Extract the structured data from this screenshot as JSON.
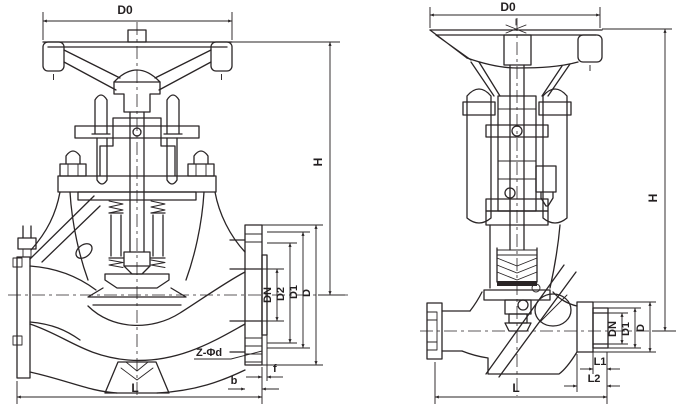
{
  "page": {
    "background": "#ffffff",
    "line_color": "#2a2526"
  },
  "figure": {
    "type": "technical-drawing",
    "description": "Dimensional cross-section drawings of two globe valves: flanged pattern (left) and welded-end pattern (right)",
    "left_valve": {
      "labels": {
        "d0": "D0",
        "h": "H",
        "dn": "DN",
        "d2": "D2",
        "d1": "D1",
        "d": "D",
        "z_phi_d": "Z-Φd",
        "b": "b",
        "f": "f",
        "l": "L"
      }
    },
    "right_valve": {
      "labels": {
        "d0": "D0",
        "h": "H",
        "dn": "DN",
        "d1": "D1",
        "d": "D",
        "l1": "L1",
        "l2": "L2",
        "l": "L"
      }
    }
  }
}
